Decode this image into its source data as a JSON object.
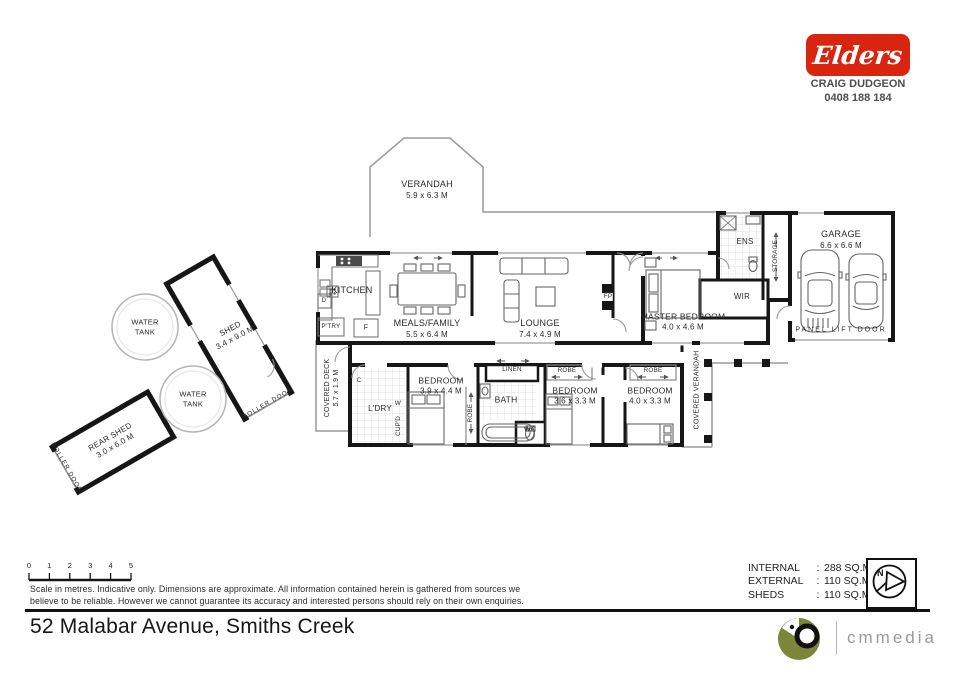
{
  "agency": {
    "brand": "Elders",
    "agent": "CRAIG DUDGEON",
    "phone": "0408 188 184"
  },
  "plan": {
    "verandah": {
      "name": "VERANDAH",
      "dims": "5.9 x 6.3 M"
    },
    "kitchen": {
      "name": "KITCHEN"
    },
    "pantry": {
      "name": "P'TRY"
    },
    "fridge": {
      "name": "F"
    },
    "dishwasher": {
      "name": "D"
    },
    "meals": {
      "name": "MEALS/FAMILY",
      "dims": "5.5 x 6.4 M"
    },
    "lounge": {
      "name": "LOUNGE",
      "dims": "7.4 x 4.9 M"
    },
    "fireplace": {
      "name": "FP"
    },
    "master": {
      "name": "MASTER BEDROOM",
      "dims": "4.0 x 4.6 M"
    },
    "ensuite": {
      "name": "ENS"
    },
    "wir": {
      "name": "WIR"
    },
    "storage": {
      "name": "STORAGE"
    },
    "garage": {
      "name": "GARAGE",
      "dims": "6.6 x 6.6 M"
    },
    "panel_lift_door": {
      "name": "PANEL LIFT DOOR"
    },
    "covered_deck": {
      "name": "COVERED DECK",
      "dims": "5.7 x 1.9 M"
    },
    "laundry": {
      "name": "L'DRY"
    },
    "cupboard": {
      "name": "CUP'D"
    },
    "cupboard_c": {
      "name": "C"
    },
    "washer": {
      "name": "W"
    },
    "bedroom1": {
      "name": "BEDROOM",
      "dims": "3.9 x 4.4 M"
    },
    "robe1": {
      "name": "ROBE"
    },
    "linen": {
      "name": "LINEN"
    },
    "bath": {
      "name": "BATH"
    },
    "wc": {
      "name": "WC"
    },
    "bedroom2": {
      "name": "BEDROOM",
      "dims": "3.6 x 3.3 M"
    },
    "robe2": {
      "name": "ROBE"
    },
    "bedroom3": {
      "name": "BEDROOM",
      "dims": "4.0 x 3.3 M"
    },
    "robe3": {
      "name": "ROBE"
    },
    "covered_verandah": {
      "name": "COVERED VERANDAH"
    },
    "shed": {
      "name": "SHED",
      "dims": "3.4 x 9.0 M",
      "door": "ROLLER DOOR"
    },
    "rear_shed": {
      "name": "REAR SHED",
      "dims": "3.0 x 6.0 M",
      "door": "ROLLER DOOR"
    },
    "water_tank_1": {
      "name": "WATER TANK"
    },
    "water_tank_2": {
      "name": "WATER TANK"
    }
  },
  "footer": {
    "scale_ticks": [
      "0",
      "1",
      "2",
      "3",
      "4",
      "5"
    ],
    "scale_note1": "Scale in metres.  Indicative only.  Dimensions are approximate.  All information contained herein is gathered from sources we",
    "scale_note2": "believe to be reliable.  However we cannot guarantee its accuracy and interested persons should rely on their own enquiries.",
    "areas": [
      {
        "label": "INTERNAL",
        "value": "288 SQ.M."
      },
      {
        "label": "EXTERNAL",
        "value": "110 SQ.M."
      },
      {
        "label": "SHEDS",
        "value": "110 SQ.M."
      }
    ],
    "colon": ":",
    "north": "N",
    "address": "52 Malabar Avenue, Smiths Creek",
    "media": "cmmedia"
  },
  "colors": {
    "brand_red": "#d9250f",
    "media_olive": "#7b8638",
    "wall": "#161616"
  }
}
